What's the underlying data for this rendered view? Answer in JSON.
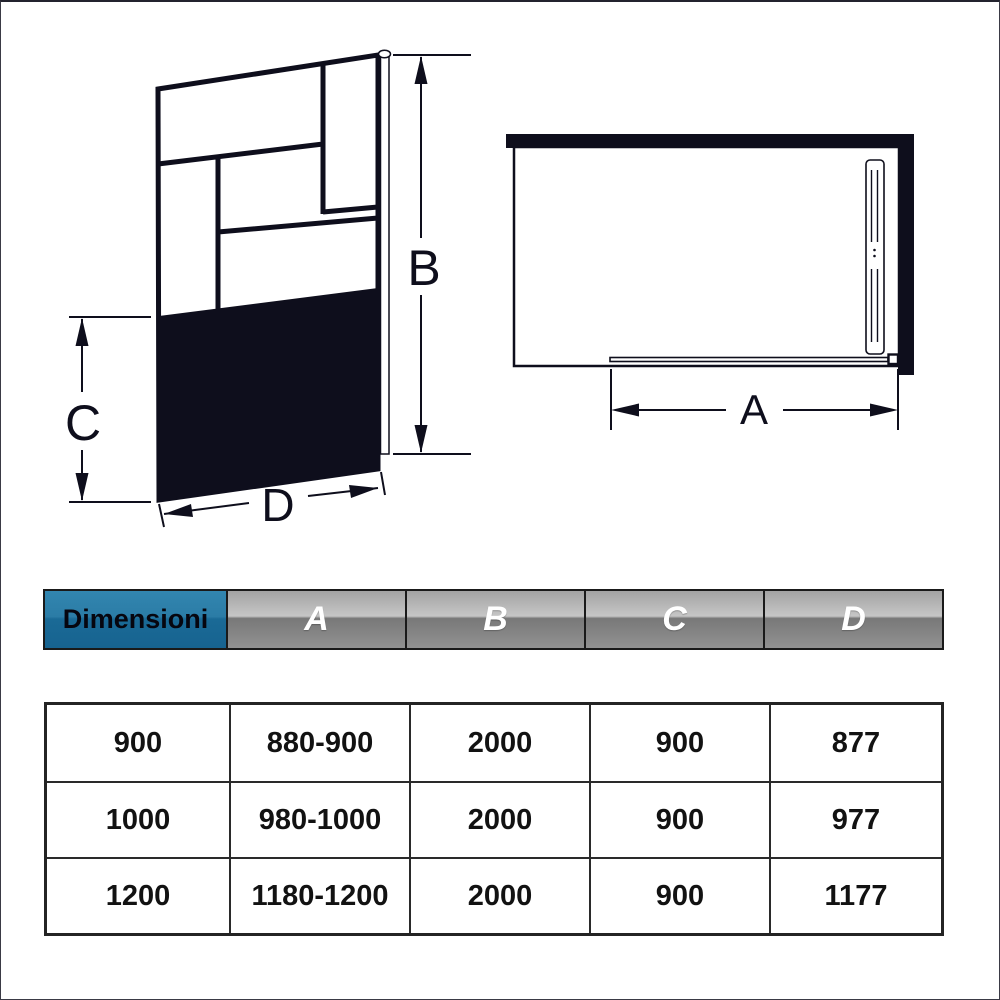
{
  "colors": {
    "line": "#0e0e1c",
    "header_blue_top": "#3286b0",
    "header_blue_bottom": "#176390",
    "header_gray_top": "#c6c6c6",
    "header_gray_bottom": "#929292",
    "header_text_gray_cells": "#ffffff",
    "header_text_blue_cell": "#06060f"
  },
  "front_view": {
    "labels": {
      "height": "B",
      "lower_height": "C",
      "width": "D"
    }
  },
  "top_view": {
    "labels": {
      "entry_width": "A"
    }
  },
  "table": {
    "header": {
      "title": "Dimensioni",
      "columns": [
        "A",
        "B",
        "C",
        "D"
      ]
    },
    "rows": [
      [
        "900",
        "880-900",
        "2000",
        "900",
        "877"
      ],
      [
        "1000",
        "980-1000",
        "2000",
        "900",
        "977"
      ],
      [
        "1200",
        "1180-1200",
        "2000",
        "900",
        "1177"
      ]
    ]
  }
}
